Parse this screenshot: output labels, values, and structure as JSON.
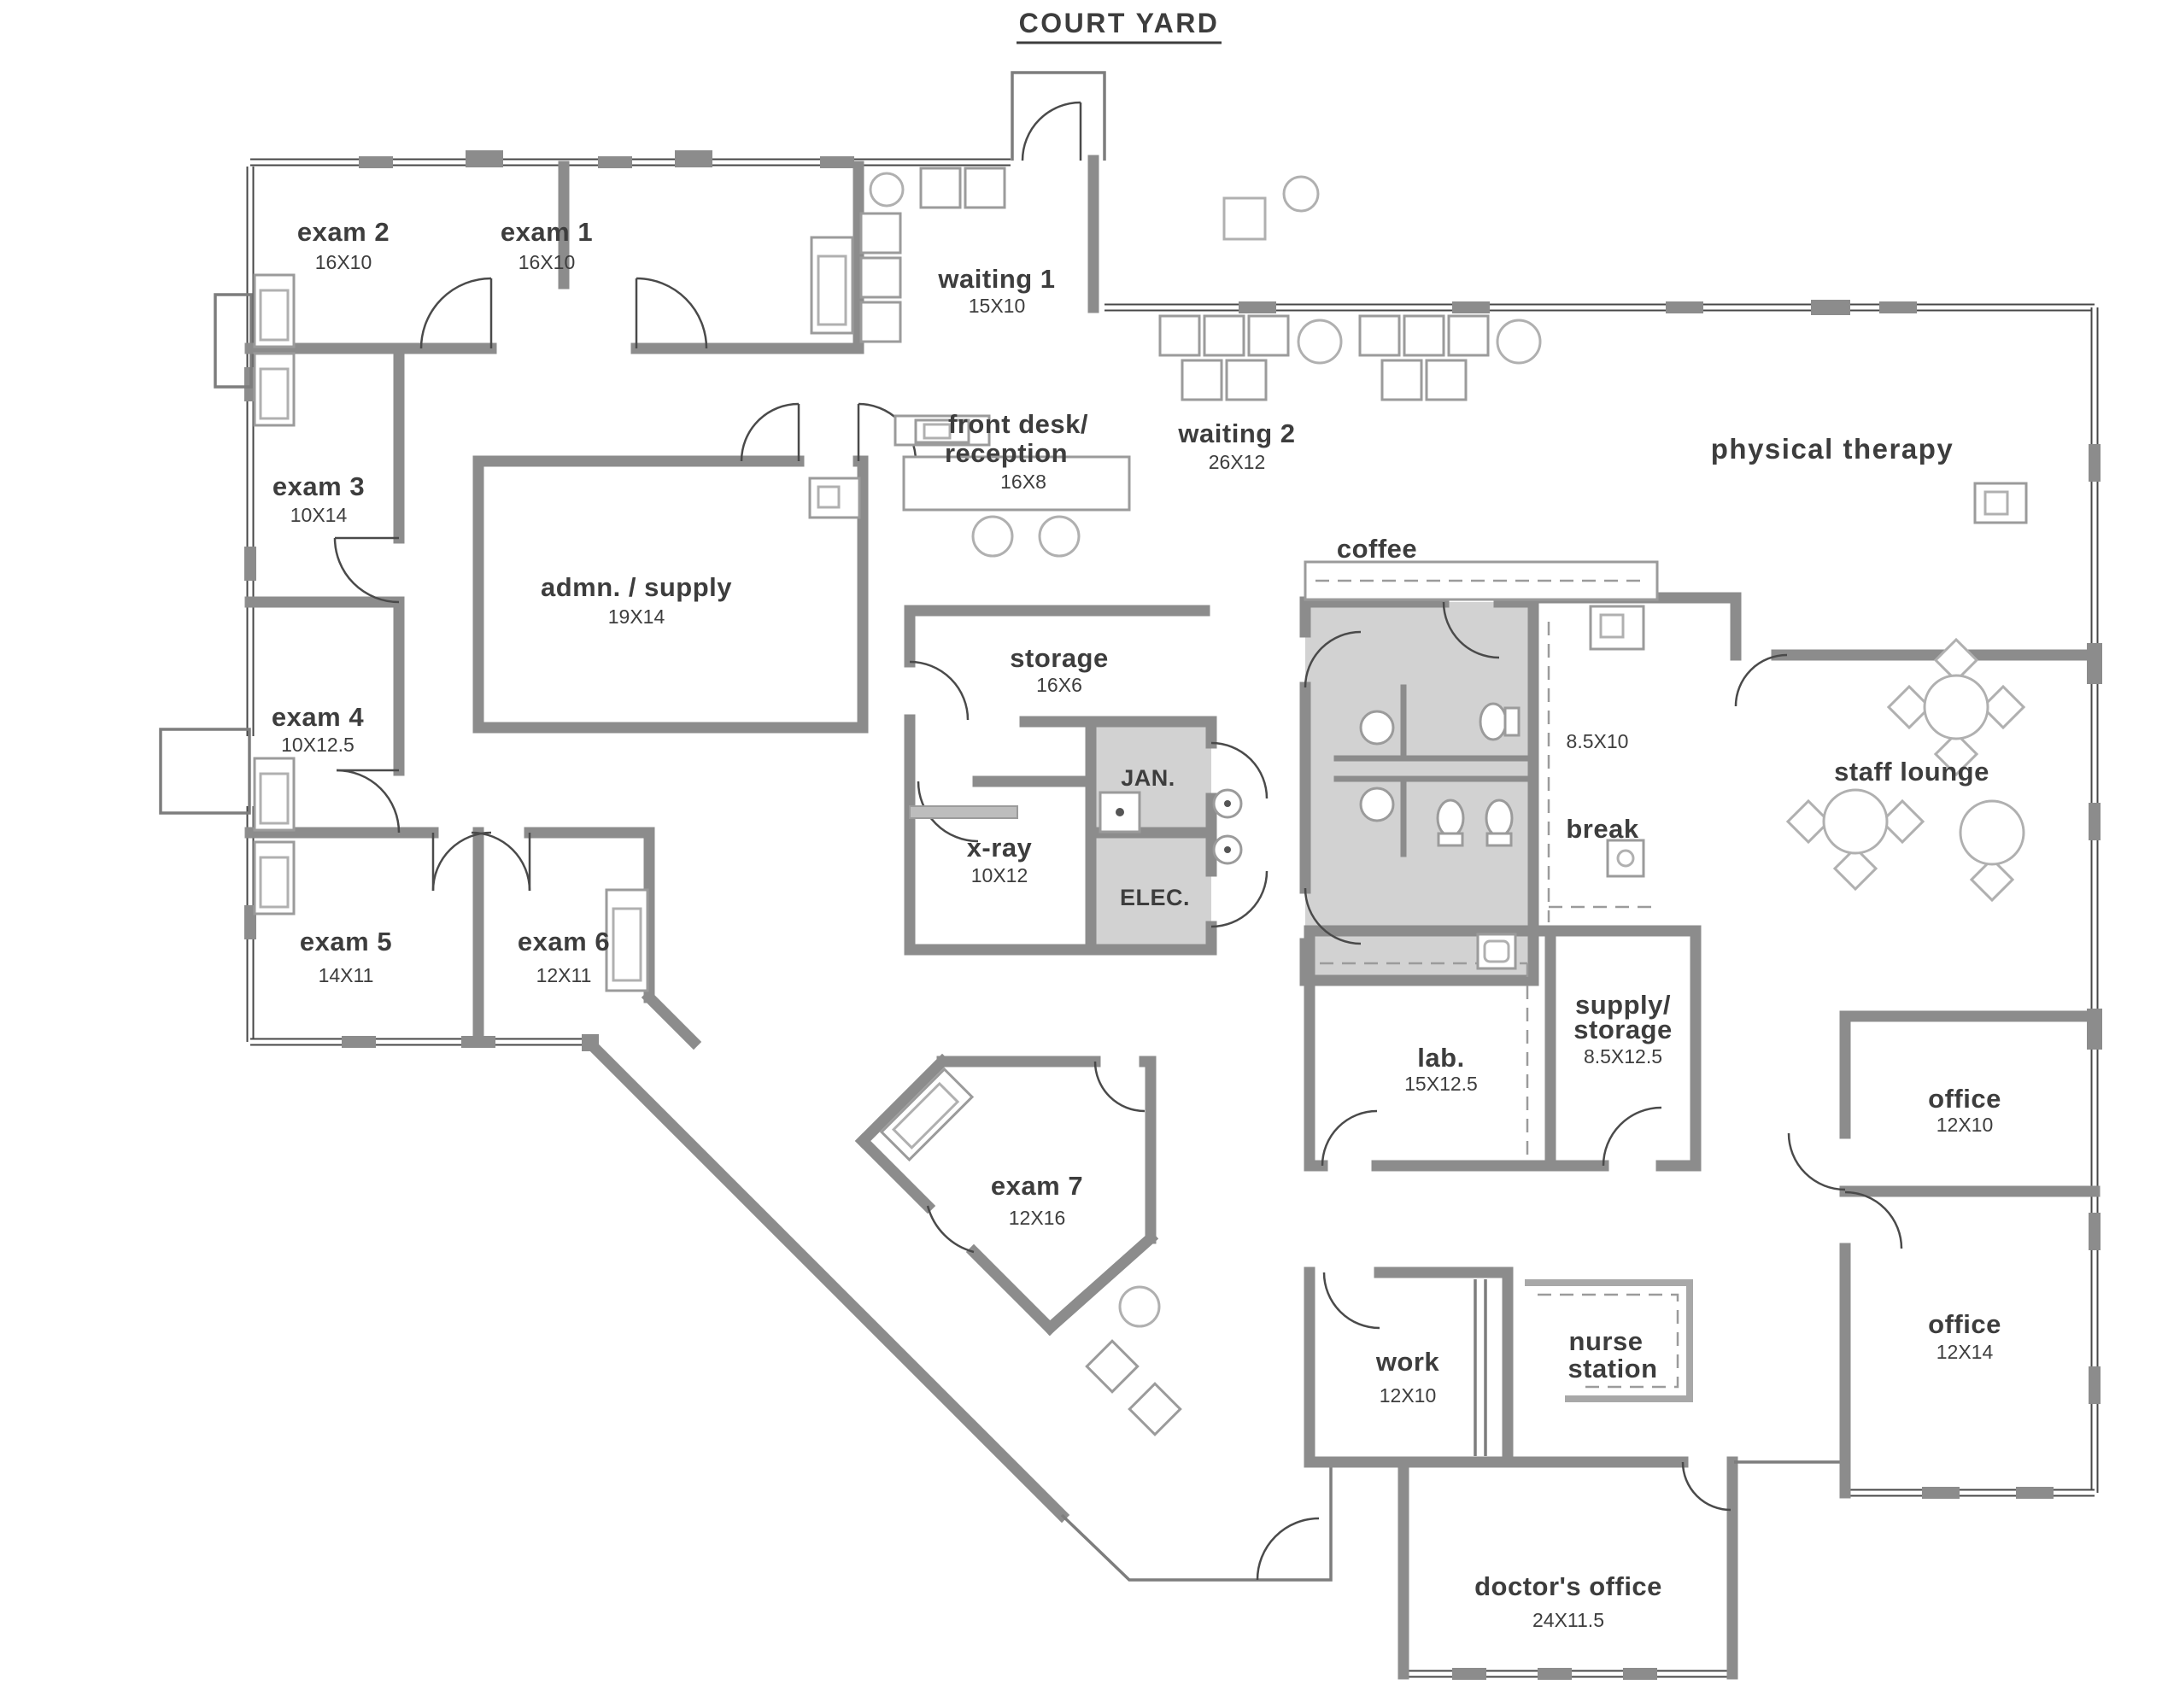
{
  "title": {
    "text": "COURT YARD"
  },
  "palette": {
    "wall_gray": "#8c8c8c",
    "shaded_room_gray": "#d2d2d2",
    "text_gray": "#3d3d3d"
  },
  "rooms": {
    "exam1": {
      "label": "exam 1",
      "dims": "16X10"
    },
    "exam2": {
      "label": "exam 2",
      "dims": "16X10"
    },
    "exam3": {
      "label": "exam 3",
      "dims": "10X14"
    },
    "exam4": {
      "label": "exam 4",
      "dims": "10X12.5"
    },
    "exam5": {
      "label": "exam 5",
      "dims": "14X11"
    },
    "exam6": {
      "label": "exam 6",
      "dims": "12X11"
    },
    "exam7": {
      "label": "exam 7",
      "dims": "12X16"
    },
    "waiting1": {
      "label": "waiting 1",
      "dims": "15X10"
    },
    "waiting2": {
      "label": "waiting 2",
      "dims": "26X12"
    },
    "front_desk": {
      "line1": "front desk/",
      "line2": "reception",
      "dims": "16X8"
    },
    "admn_supply": {
      "label": "admn. / supply",
      "dims": "19X14"
    },
    "storage": {
      "label": "storage",
      "dims": "16X6"
    },
    "xray": {
      "label": "x-ray",
      "dims": "10X12"
    },
    "jan": {
      "label": "JAN."
    },
    "elec": {
      "label": "ELEC."
    },
    "coffee": {
      "label": "coffee"
    },
    "break_room": {
      "label": "break",
      "dims": "8.5X10"
    },
    "physical_therapy": {
      "label": "physical therapy"
    },
    "staff_lounge": {
      "label": "staff lounge"
    },
    "lab": {
      "label": "lab.",
      "dims": "15X12.5"
    },
    "supply_storage": {
      "line1": "supply/",
      "line2": "storage",
      "dims": "8.5X12.5"
    },
    "office1": {
      "label": "office",
      "dims": "12X10"
    },
    "office2": {
      "label": "office",
      "dims": "12X14"
    },
    "work": {
      "label": "work",
      "dims": "12X10"
    },
    "nurse_station": {
      "line1": "nurse",
      "line2": "station"
    },
    "doctors_office": {
      "label": "doctor's office",
      "dims": "24X11.5"
    }
  }
}
